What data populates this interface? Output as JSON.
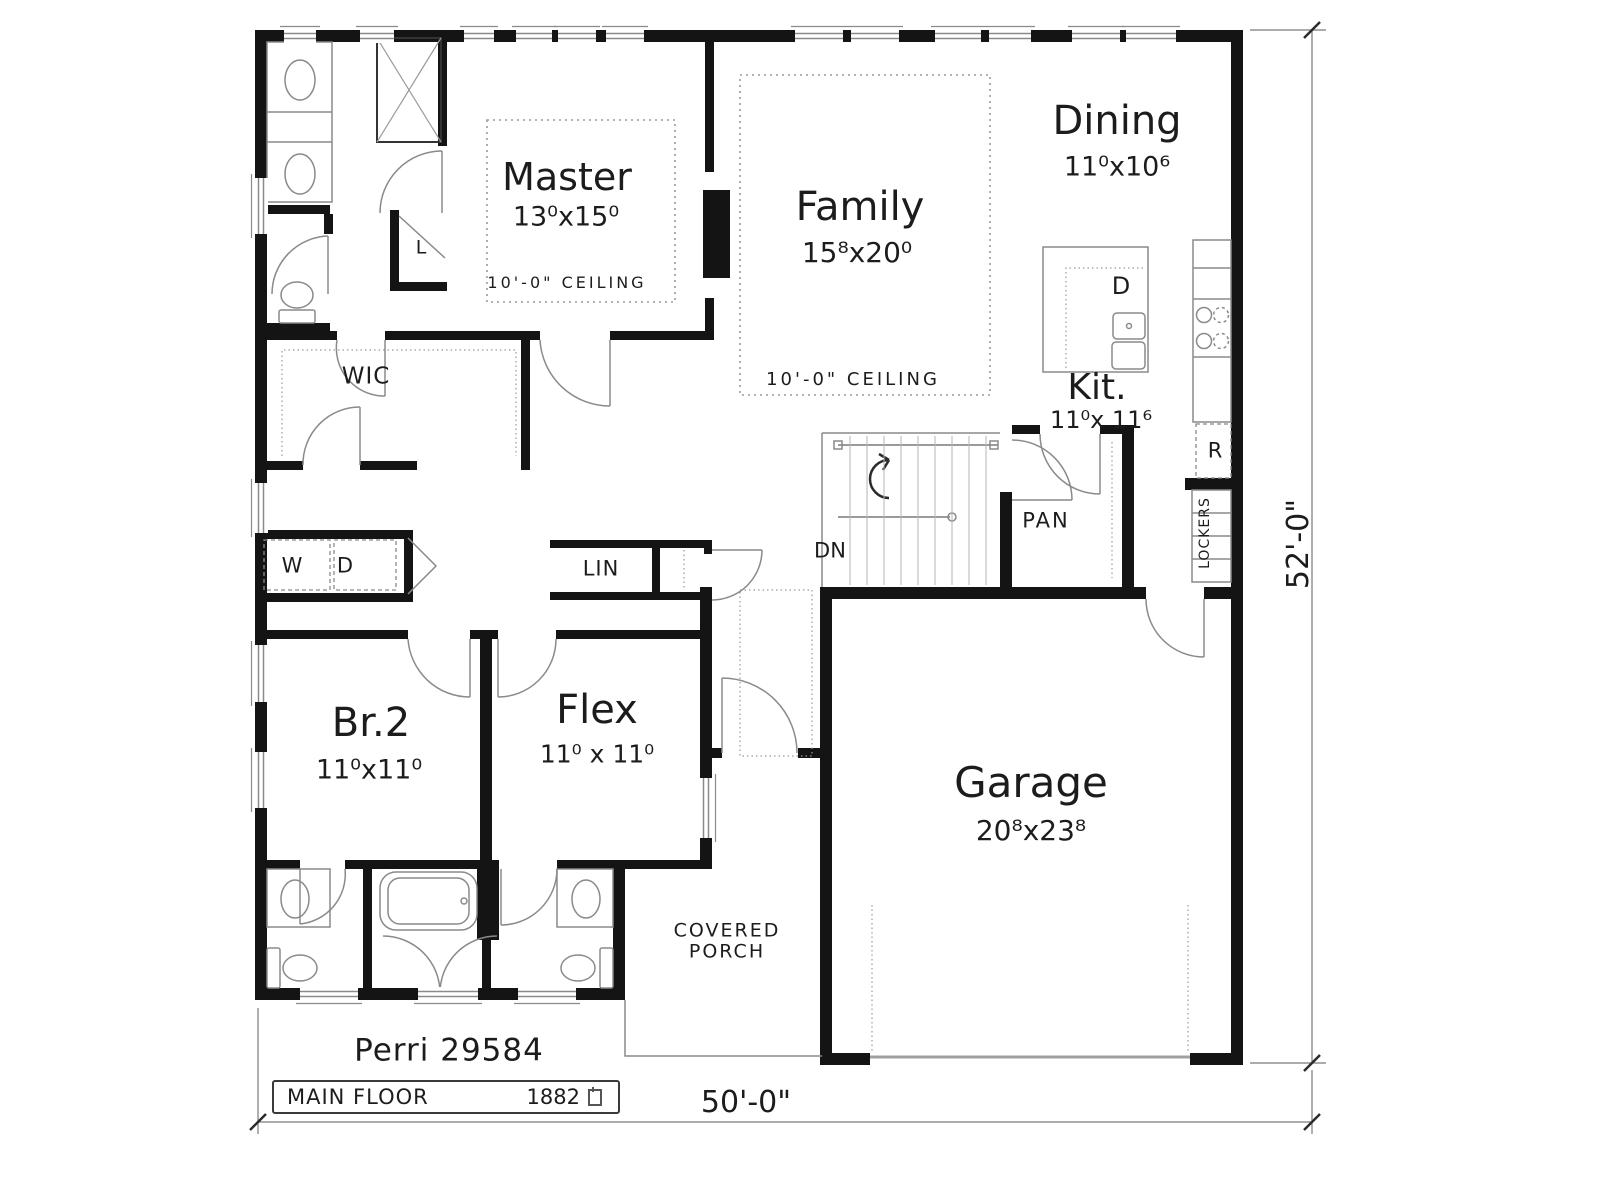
{
  "plan": {
    "title": "Perri 29584",
    "floor": {
      "label": "MAIN FLOOR",
      "area": "1882"
    },
    "overall_dimensions": {
      "width": "50'-0\"",
      "depth": "52'-0\""
    },
    "rooms": {
      "master": {
        "name": "Master",
        "size": "13⁰x15⁰",
        "ceiling": "10'-0\" CEILING"
      },
      "family": {
        "name": "Family",
        "size": "15⁸x20⁰",
        "ceiling": "10'-0\" CEILING"
      },
      "dining": {
        "name": "Dining",
        "size": "11⁰x10⁶"
      },
      "kitchen": {
        "name": "Kit.",
        "size": "11⁰x 11⁶"
      },
      "bedroom2": {
        "name": "Br.2",
        "size": "11⁰x11⁰"
      },
      "flex": {
        "name": "Flex",
        "size": "11⁰ x 11⁰"
      },
      "garage": {
        "name": "Garage",
        "size": "20⁸x23⁸"
      },
      "porch": {
        "line1": "COVERED",
        "line2": "PORCH"
      }
    },
    "labels": {
      "walk_in_closet": "WIC",
      "linen_cabinet": "LIN",
      "pantry": "PAN",
      "stairs_down": "DN",
      "washer": "W",
      "dryer": "D",
      "linen": "L",
      "dishwasher": "D",
      "refrigerator": "R",
      "lockers": "LOCKERS"
    },
    "colors": {
      "wall": "#141414",
      "fixture_line": "#8a8a8a",
      "dashed_line": "#9a9a9a",
      "text": "#1c1c1c"
    }
  }
}
